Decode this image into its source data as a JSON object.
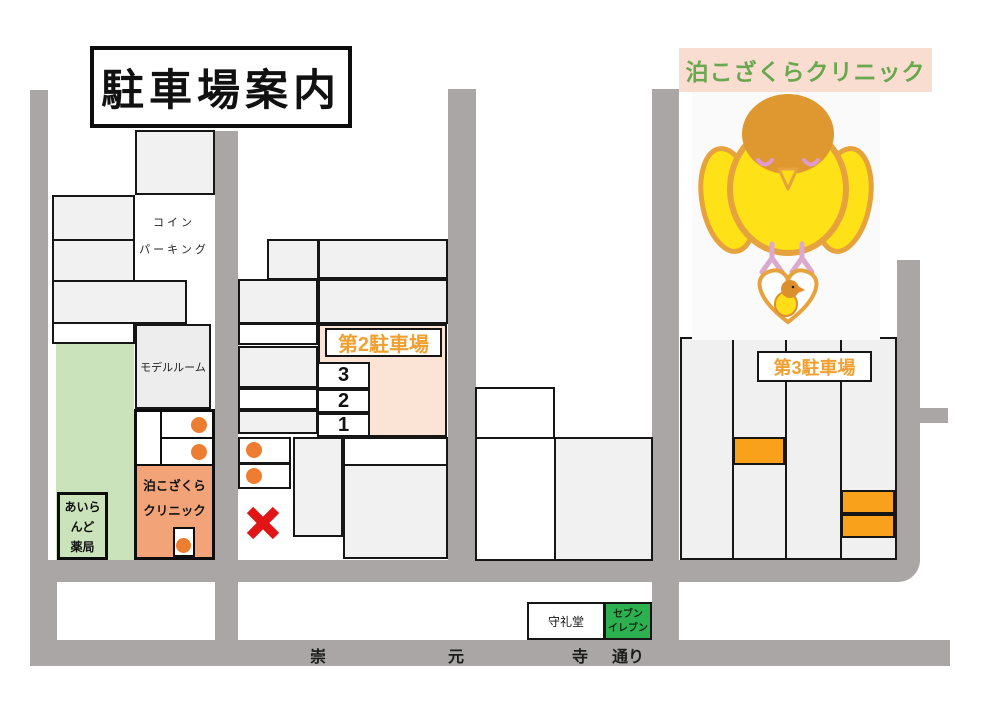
{
  "page": {
    "title": "駐車場案内"
  },
  "clinic_banner": {
    "text": "泊こざくらクリニック"
  },
  "block1": {
    "coin_parking_line1": "コイン",
    "coin_parking_line2": "パーキング",
    "model_room": "モデルルーム",
    "pharmacy_line1": "あいら",
    "pharmacy_line2": "んど",
    "pharmacy_line3": "薬局",
    "clinic_line1": "泊こざくら",
    "clinic_line2": "クリニック"
  },
  "parking2": {
    "label": "第2駐車場",
    "bays": [
      "3",
      "2",
      "1"
    ]
  },
  "parking3": {
    "label": "第3駐車場"
  },
  "landmarks": {
    "shureido": "守礼堂",
    "seven_line1": "セブン",
    "seven_line2": "イレブン"
  },
  "street": {
    "char1": "崇",
    "char2": "元",
    "char3": "寺",
    "char4": "通り"
  },
  "colors": {
    "road_gray": "#ABA6A6",
    "building_gray": "#F1F1F1",
    "lot_green": "#CBE3BA",
    "seven_green": "#2DB04F",
    "clinic_orange": "#F2A478",
    "marker_orange": "#ED7D31",
    "parking_orange": "#F9A11B",
    "peach_area": "#FBE4D5",
    "label_orange": "#F0A030",
    "banner_pink": "#FADDD1",
    "banner_green_text": "#6AA84F",
    "cross_red": "#E01515"
  }
}
